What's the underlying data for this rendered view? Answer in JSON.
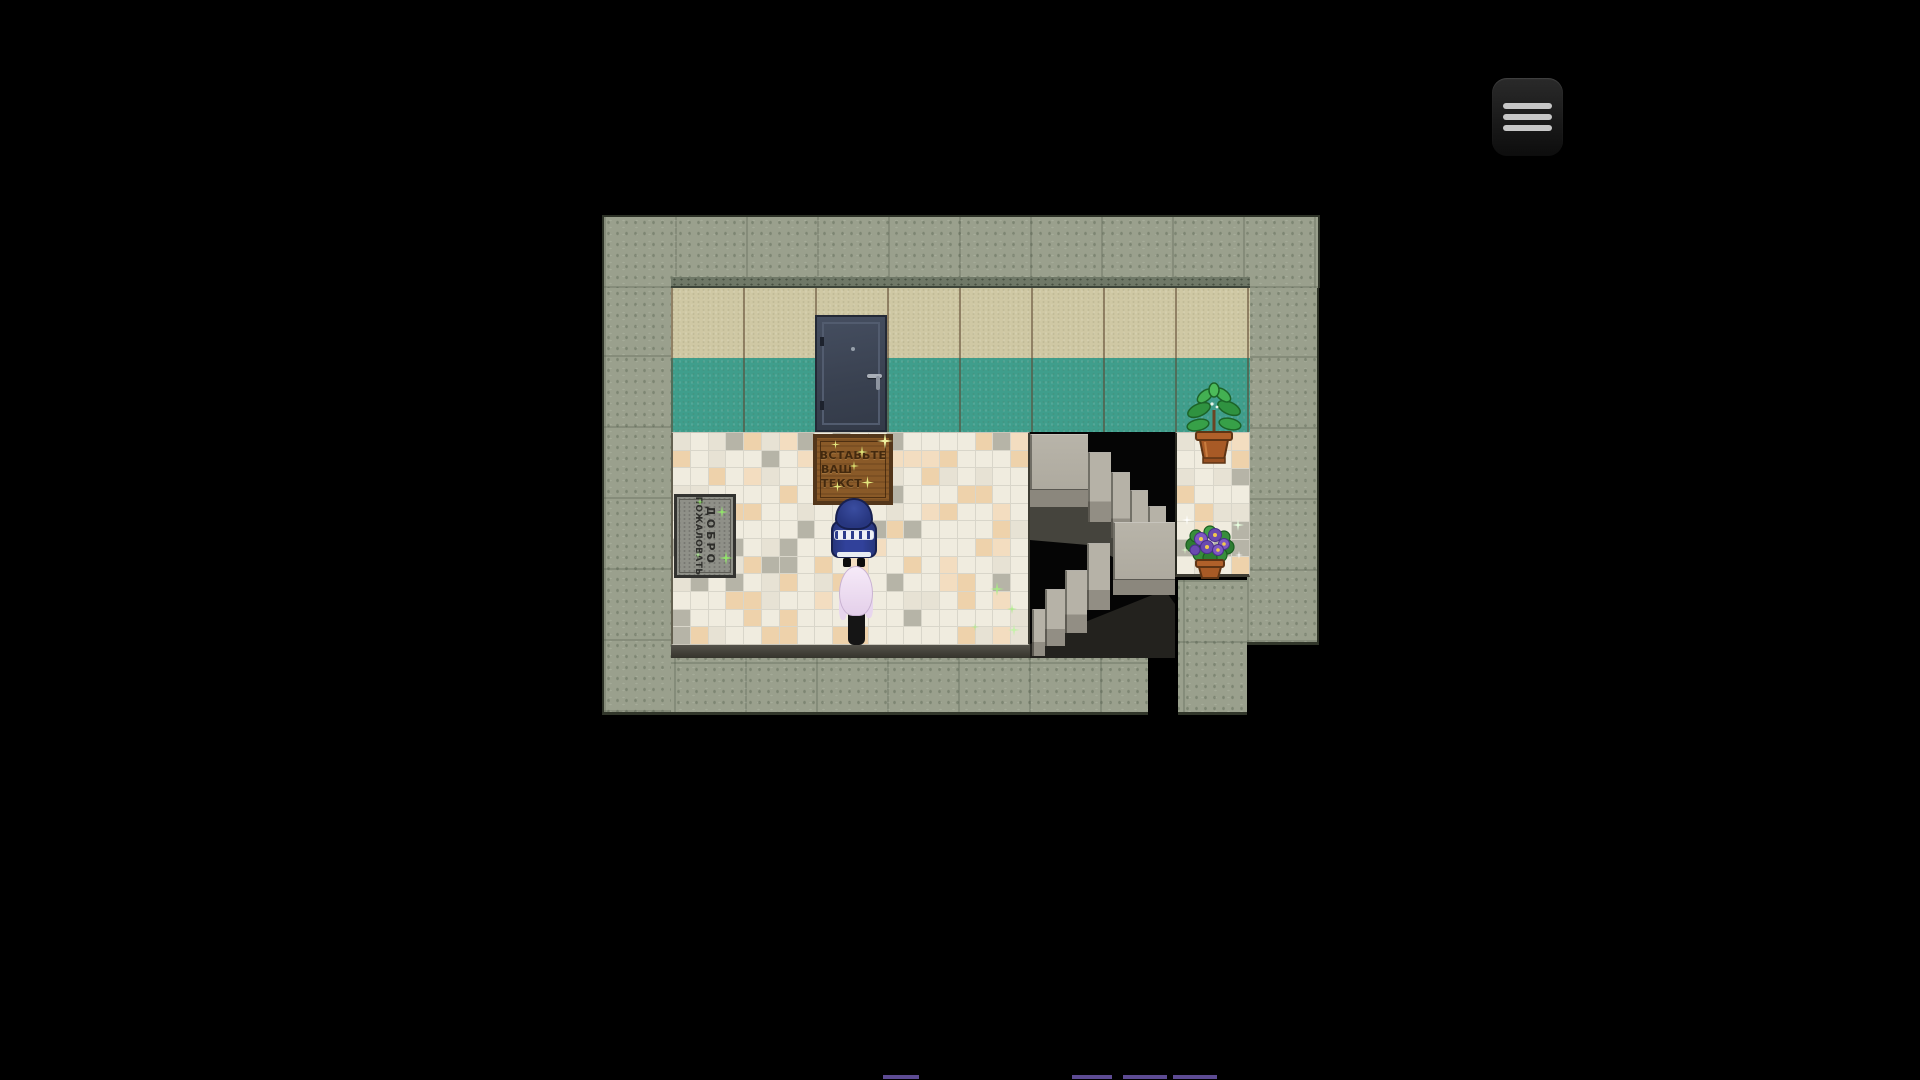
{
  "title": "RPG room scene",
  "menu": {
    "icon": "hamburger-icon"
  },
  "room": {
    "door_mat": {
      "line1": "ВСТАВЬТЕ",
      "line2": "ВАШ ТЕКСТ"
    },
    "welcome_mat": {
      "line1": "ДОБРО",
      "line2": "ПОЖАЛОВАТЬ"
    }
  },
  "colors": {
    "background": "#000000",
    "stone": "#9aa08d",
    "wall_upper": "#cfc8a4",
    "wall_lower": "#3f9e8c",
    "grout": "#d9d6ca",
    "floor_white": "#f0ecdf",
    "floor_offwhite": "#e7e2d4",
    "floor_peach": "#eed2ab",
    "floor_peach_light": "#f3ddc0",
    "floor_gray": "#b6b4a7",
    "door": "#3a4150",
    "door_mat": "#8a5a28",
    "welcome_mat": "#8f9088",
    "sparkle_yellow": "#e4e87e",
    "sparkle_green": "#92e46a",
    "accent_purple": "#5d4b93"
  }
}
